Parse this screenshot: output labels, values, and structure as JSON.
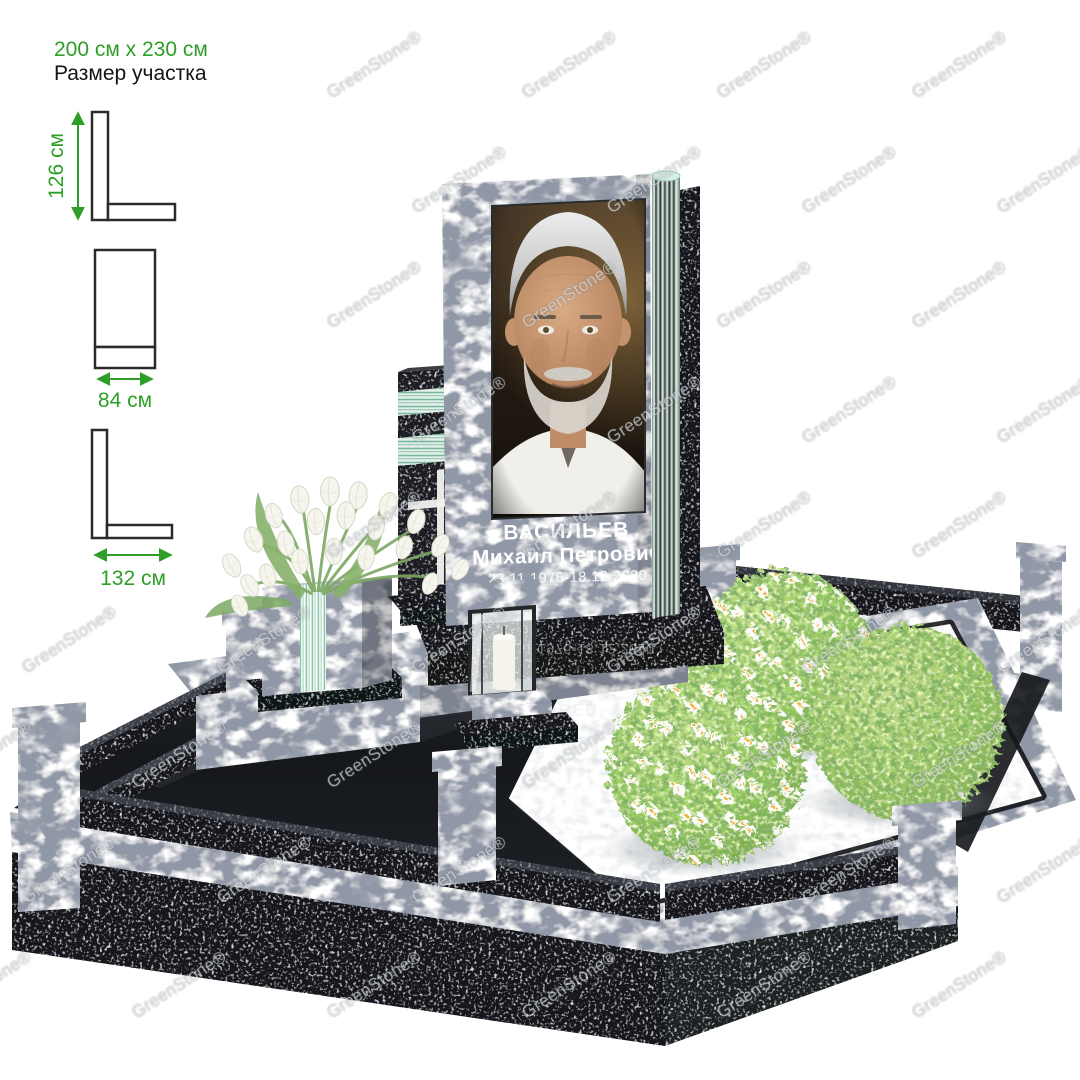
{
  "annotation": {
    "plot_size": "200 см x 230 см",
    "plot_caption": "Размер участка"
  },
  "dimensions": {
    "stele_height": "126 см",
    "stele_width": "84 см",
    "base_depth": "132 см"
  },
  "memorial": {
    "surname": "ВАСИЛЬЕВ",
    "given_names": "Михаил Петрович",
    "dates": "23.11.1976-18.12.2020"
  },
  "watermark": {
    "text": "GreenStone®"
  },
  "colors": {
    "dimension_green": "#2f9e28",
    "granite_gray": "#9aa2ae",
    "granite_black": "#17191c",
    "glass_green": "#bfe3d4",
    "foliage_green": "#8fcb5a",
    "gravel_white": "#eef0f2",
    "engraving_white": "#ffffff"
  }
}
